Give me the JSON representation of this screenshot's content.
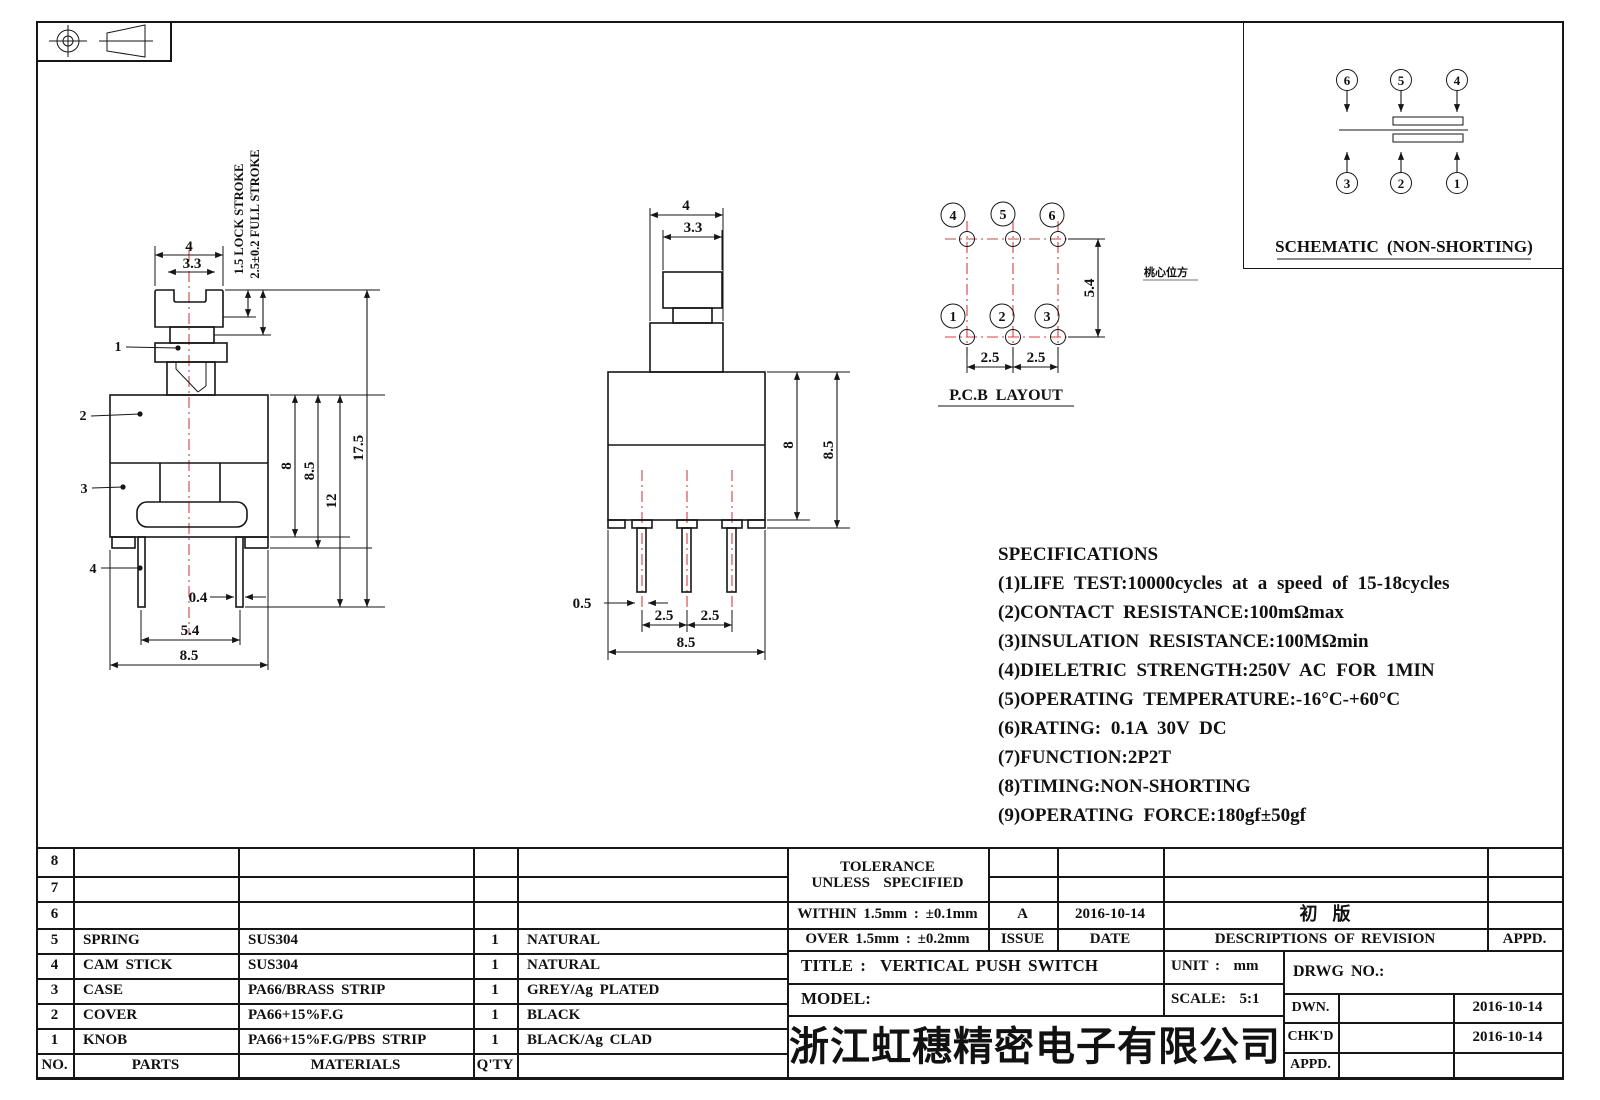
{
  "colors": {
    "line": "#161616",
    "centerline_red": "#cc4444",
    "paper": "#ffffff"
  },
  "front_view": {
    "dim_width_top": "4",
    "dim_width_inner": "3.3",
    "lock_stroke": "1.5 LOCK STROKE",
    "full_stroke": "2.5±0.2 FULL STROKE",
    "dim_body": "8",
    "dim_body2": "8.5",
    "dim_12": "12",
    "dim_total": "17.5",
    "dim_pin_w": "0.4",
    "dim_pin_span": "5.4",
    "dim_base": "8.5",
    "part_1": "1",
    "part_2": "2",
    "part_3": "3",
    "part_4": "4"
  },
  "side_view": {
    "dim_top": "4",
    "dim_knob": "3.3",
    "dim_body": "8",
    "dim_body2": "8.5",
    "dim_pin_w": "0.5",
    "dim_pitch1": "2.5",
    "dim_pitch2": "2.5",
    "dim_base": "8.5"
  },
  "pcb_layout": {
    "title": "P.C.B LAYOUT",
    "note": "桃心位方",
    "pin_top_1": "4",
    "pin_top_2": "5",
    "pin_top_3": "6",
    "pin_bot_1": "1",
    "pin_bot_2": "2",
    "pin_bot_3": "3",
    "dim_v": "5.4",
    "dim_h1": "2.5",
    "dim_h2": "2.5"
  },
  "schematic": {
    "title": "SCHEMATIC (NON-SHORTING)",
    "pin_top_1": "6",
    "pin_top_2": "5",
    "pin_top_3": "4",
    "pin_bot_1": "3",
    "pin_bot_2": "2",
    "pin_bot_3": "1"
  },
  "specifications": {
    "title": "SPECIFICATIONS",
    "items": [
      "(1)LIFE TEST:10000cycles at a speed of 15-18cycles",
      "(2)CONTACT RESISTANCE:100mΩmax",
      "(3)INSULATION RESISTANCE:100MΩmin",
      "(4)DIELETRIC STRENGTH:250V AC FOR 1MIN",
      "(5)OPERATING TEMPERATURE:-16°C-+60°C",
      "(6)RATING: 0.1A 30V DC",
      "(7)FUNCTION:2P2T",
      "(8)TIMING:NON-SHORTING",
      "(9)OPERATING FORCE:180gf±50gf"
    ]
  },
  "parts_table": {
    "headers": {
      "no": "NO.",
      "parts": "PARTS",
      "materials": "MATERIALS",
      "qty": "Q'TY"
    },
    "rows": [
      {
        "no": "8",
        "part": "",
        "material": "",
        "qty": "",
        "color": ""
      },
      {
        "no": "7",
        "part": "",
        "material": "",
        "qty": "",
        "color": ""
      },
      {
        "no": "6",
        "part": "",
        "material": "",
        "qty": "",
        "color": ""
      },
      {
        "no": "5",
        "part": "SPRING",
        "material": "SUS304",
        "qty": "1",
        "color": "NATURAL"
      },
      {
        "no": "4",
        "part": "CAM STICK",
        "material": "SUS304",
        "qty": "1",
        "color": "NATURAL"
      },
      {
        "no": "3",
        "part": "CASE",
        "material": "PA66/BRASS STRIP",
        "qty": "1",
        "color": "GREY/Ag PLATED"
      },
      {
        "no": "2",
        "part": "COVER",
        "material": "PA66+15%F.G",
        "qty": "1",
        "color": "BLACK"
      },
      {
        "no": "1",
        "part": "KNOB",
        "material": "PA66+15%F.G/PBS STRIP",
        "qty": "1",
        "color": "BLACK/Ag CLAD"
      }
    ]
  },
  "tolerance_block": {
    "line1": "TOLERANCE",
    "line2": "UNLESS  SPECIFIED",
    "within": "WITHIN 1.5mm : ±0.1mm",
    "over": "OVER 1.5mm : ±0.2mm"
  },
  "revision_block": {
    "issue_value": "A",
    "date_value": "2016-10-14",
    "issue_label": "ISSUE",
    "date_label": "DATE",
    "description_value": "初  版",
    "description_label": "DESCRIPTIONS OF REVISION",
    "appd_label": "APPD."
  },
  "title_block": {
    "title": "TITLE :  VERTICAL PUSH SWITCH",
    "model_label": "MODEL:",
    "unit": "UNIT :  mm",
    "scale": "SCALE:  5:1",
    "drwg_no": "DRWG NO.:",
    "dwn_label": "DWN.",
    "chkd_label": "CHK'D",
    "appd_label": "APPD.",
    "dwn_date": "2016-10-14",
    "chkd_date": "2016-10-14",
    "company": "浙江虹穗精密电子有限公司"
  }
}
